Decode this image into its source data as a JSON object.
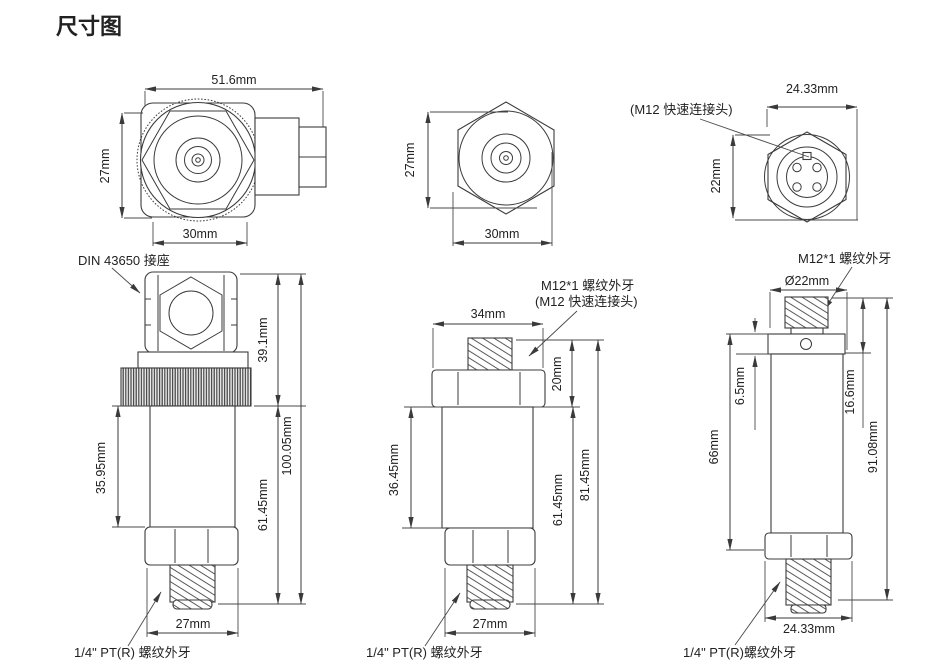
{
  "title": "尺寸图",
  "colors": {
    "title": "#2b50e0",
    "line": "#3b3b3b",
    "text": "#222222"
  },
  "views": {
    "top_left": {
      "dim_width_overall": "51.6mm",
      "dim_height": "27mm",
      "dim_width_hex": "30mm"
    },
    "top_middle": {
      "dim_height": "27mm",
      "dim_width_hex": "30mm"
    },
    "top_right": {
      "label_connector": "(M12 快速连接头)",
      "dim_width_overall": "24.33mm",
      "dim_height": "22mm"
    },
    "side_left": {
      "label_connector": "DIN 43650 接座",
      "dim_top_section": "39.1mm",
      "dim_body": "35.95mm",
      "dim_lower_section": "61.45mm",
      "dim_total": "100.05mm",
      "dim_hex_width": "27mm",
      "label_thread": "1/4\" PT(R) 螺纹外牙"
    },
    "side_middle": {
      "label_thread_top": "M12*1 螺纹外牙",
      "label_connector": "(M12 快速连接头)",
      "dim_hex_top_width": "34mm",
      "dim_top_section": "20mm",
      "dim_body": "36.45mm",
      "dim_lower_section": "61.45mm",
      "dim_total": "81.45mm",
      "dim_hex_width": "27mm",
      "label_thread": "1/4\" PT(R) 螺纹外牙"
    },
    "side_right": {
      "label_thread_top": "M12*1 螺纹外牙",
      "dim_thread_dia": "Ø22mm",
      "dim_collar": "6.5mm",
      "dim_top_section": "16.6mm",
      "dim_body": "66mm",
      "dim_total": "91.08mm",
      "dim_hex_width": "24.33mm",
      "label_thread": "1/4\" PT(R)螺纹外牙"
    }
  }
}
